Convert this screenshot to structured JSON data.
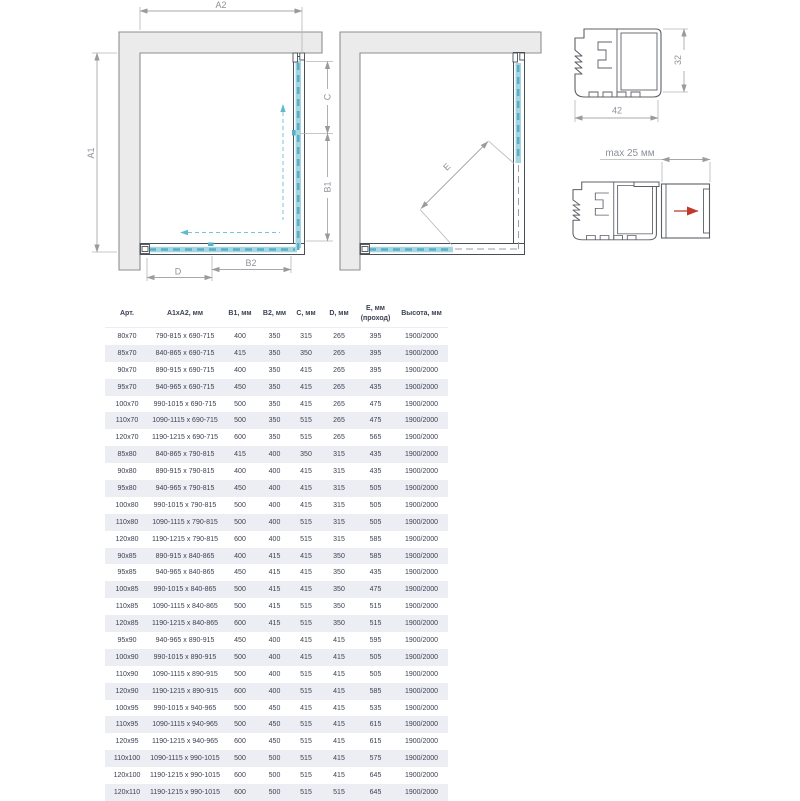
{
  "diagram": {
    "left": {
      "a1": "A1",
      "a2": "A2",
      "c": "C",
      "b1": "B1",
      "b2": "B2",
      "d": "D"
    },
    "middle": {
      "e": "E"
    },
    "profile": {
      "width": "42",
      "height": "32",
      "max_offset": "max 25 мм"
    },
    "colors": {
      "glass": "#a6d5e2",
      "glass_dash": "#58b0c8",
      "wall": "#ebebeb",
      "dim_line": "#a8a8a8",
      "red_arrow": "#c0392b"
    }
  },
  "table": {
    "headers": [
      "Арт.",
      "А1хА2, мм",
      "В1, мм",
      "В2, мм",
      "С, мм",
      "D, мм",
      "Е, мм\n(проход)",
      "Высота, мм"
    ],
    "rows": [
      [
        "80x70",
        "790-815 x 690-715",
        "400",
        "350",
        "315",
        "265",
        "395",
        "1900/2000"
      ],
      [
        "85x70",
        "840-865 x 690-715",
        "415",
        "350",
        "350",
        "265",
        "395",
        "1900/2000"
      ],
      [
        "90x70",
        "890-915 x 690-715",
        "400",
        "350",
        "415",
        "265",
        "395",
        "1900/2000"
      ],
      [
        "95x70",
        "940-965 x 690-715",
        "450",
        "350",
        "415",
        "265",
        "435",
        "1900/2000"
      ],
      [
        "100x70",
        "990-1015 x 690-715",
        "500",
        "350",
        "415",
        "265",
        "475",
        "1900/2000"
      ],
      [
        "110x70",
        "1090-1115 x 690-715",
        "500",
        "350",
        "515",
        "265",
        "475",
        "1900/2000"
      ],
      [
        "120x70",
        "1190-1215 x 690-715",
        "600",
        "350",
        "515",
        "265",
        "565",
        "1900/2000"
      ],
      [
        "85x80",
        "840-865 x 790-815",
        "415",
        "400",
        "350",
        "315",
        "435",
        "1900/2000"
      ],
      [
        "90x80",
        "890-915 x 790-815",
        "400",
        "400",
        "415",
        "315",
        "435",
        "1900/2000"
      ],
      [
        "95x80",
        "940-965 x 790-815",
        "450",
        "400",
        "415",
        "315",
        "505",
        "1900/2000"
      ],
      [
        "100x80",
        "990-1015 x 790-815",
        "500",
        "400",
        "415",
        "315",
        "505",
        "1900/2000"
      ],
      [
        "110x80",
        "1090-1115 x 790-815",
        "500",
        "400",
        "515",
        "315",
        "505",
        "1900/2000"
      ],
      [
        "120x80",
        "1190-1215 x 790-815",
        "600",
        "400",
        "515",
        "315",
        "585",
        "1900/2000"
      ],
      [
        "90x85",
        "890-915 x 840-865",
        "400",
        "415",
        "415",
        "350",
        "585",
        "1900/2000"
      ],
      [
        "95x85",
        "940-965 x 840-865",
        "450",
        "415",
        "415",
        "350",
        "435",
        "1900/2000"
      ],
      [
        "100x85",
        "990-1015 x 840-865",
        "500",
        "415",
        "415",
        "350",
        "475",
        "1900/2000"
      ],
      [
        "110x85",
        "1090-1115 x 840-865",
        "500",
        "415",
        "515",
        "350",
        "515",
        "1900/2000"
      ],
      [
        "120x85",
        "1190-1215 x 840-865",
        "600",
        "415",
        "515",
        "350",
        "515",
        "1900/2000"
      ],
      [
        "95x90",
        "940-965 x 890-915",
        "450",
        "400",
        "415",
        "415",
        "595",
        "1900/2000"
      ],
      [
        "100x90",
        "990-1015 x 890-915",
        "500",
        "400",
        "415",
        "415",
        "505",
        "1900/2000"
      ],
      [
        "110x90",
        "1090-1115 x 890-915",
        "500",
        "400",
        "515",
        "415",
        "505",
        "1900/2000"
      ],
      [
        "120x90",
        "1190-1215 x 890-915",
        "600",
        "400",
        "515",
        "415",
        "585",
        "1900/2000"
      ],
      [
        "100x95",
        "990-1015 x 940-965",
        "500",
        "450",
        "415",
        "415",
        "535",
        "1900/2000"
      ],
      [
        "110x95",
        "1090-1115 x 940-965",
        "500",
        "450",
        "515",
        "415",
        "615",
        "1900/2000"
      ],
      [
        "120x95",
        "1190-1215 x 940-965",
        "600",
        "450",
        "515",
        "415",
        "615",
        "1900/2000"
      ],
      [
        "110x100",
        "1090-1115 x 990-1015",
        "500",
        "500",
        "515",
        "415",
        "575",
        "1900/2000"
      ],
      [
        "120x100",
        "1190-1215 x 990-1015",
        "600",
        "500",
        "515",
        "415",
        "645",
        "1900/2000"
      ],
      [
        "120x110",
        "1190-1215 x 990-1015",
        "600",
        "500",
        "515",
        "515",
        "645",
        "1900/2000"
      ]
    ]
  }
}
